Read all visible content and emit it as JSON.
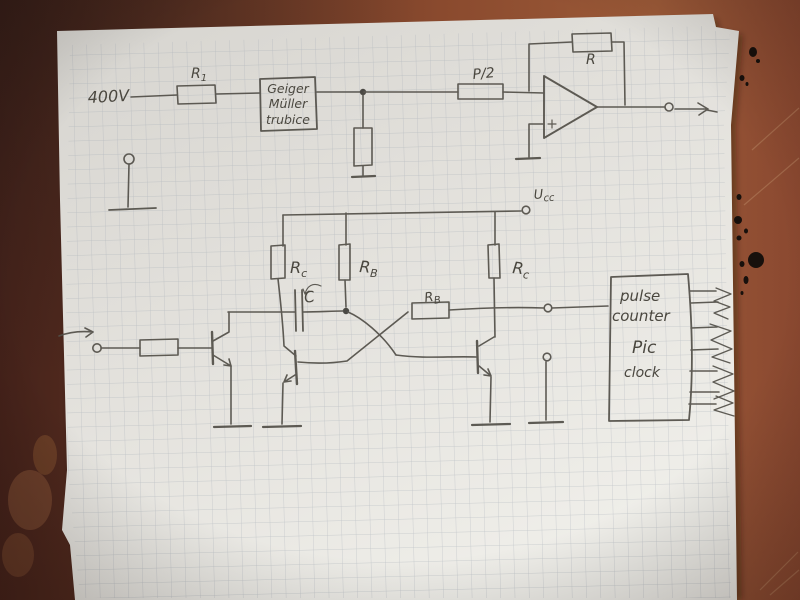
{
  "colors": {
    "table_dark": "#45221a",
    "table_mid": "#7a4026",
    "table_light": "#9c5a38",
    "paper": "#e6e4df",
    "grid_line": "#9aa3af",
    "pencil": "#524f48",
    "ink_mark": "#17100c"
  },
  "top_circuit": {
    "hv_label": "400V",
    "input_resistor_label": {
      "main": "R",
      "sub": "1"
    },
    "tube_box_lines": [
      "Geiger",
      "Müller",
      "trubice"
    ],
    "pot_label": "P/2",
    "feedback_resistor_label": "R"
  },
  "bottom_circuit": {
    "supply_label": {
      "main": "U",
      "sub": "cc"
    },
    "rc_left_label": {
      "main": "R",
      "sub": "c"
    },
    "rb_vertical_label": {
      "main": "R",
      "sub": "B"
    },
    "rc_right_label": {
      "main": "R",
      "sub": "c"
    },
    "rb_horizontal_label": {
      "main": "R",
      "sub": "B"
    },
    "capacitor_label": "C",
    "counter_box_lines": [
      "pulse",
      "counter",
      "Pic",
      "clock"
    ]
  }
}
